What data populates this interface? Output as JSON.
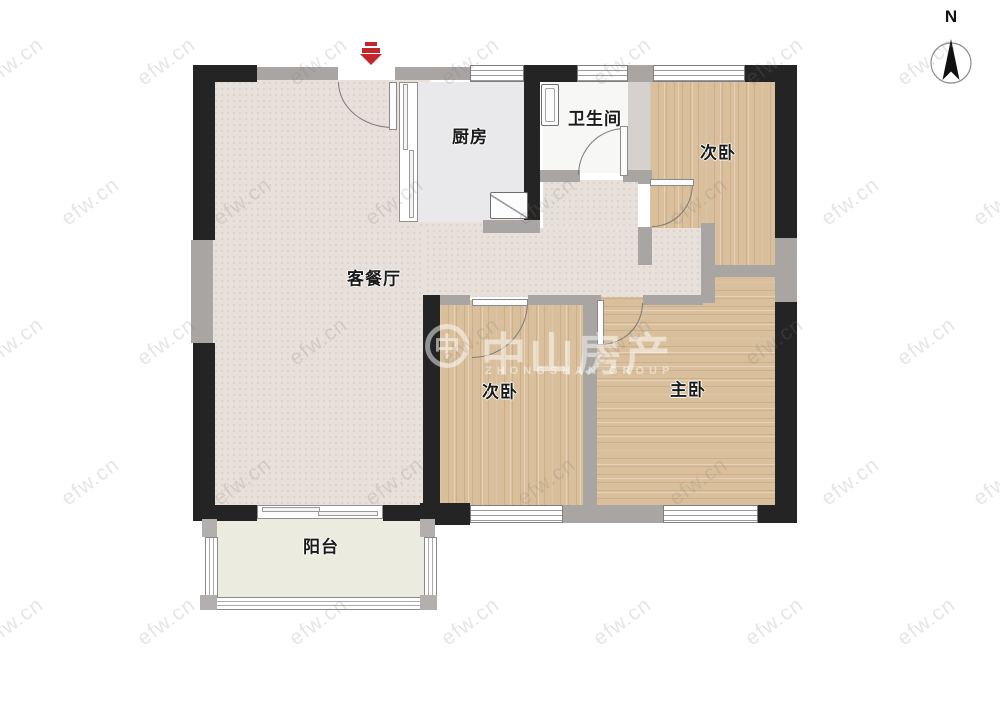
{
  "compass": {
    "label": "N"
  },
  "watermark": {
    "tile": "efw.cn",
    "brand_cn": "中山房产",
    "brand_mark": "中",
    "brand_en": "ZHONGSHAN GROUP"
  },
  "rooms": {
    "kitchen": {
      "label": "厨房"
    },
    "bathroom": {
      "label": "卫生间"
    },
    "bedroom_top_right": {
      "label": "次卧"
    },
    "living_dining": {
      "label": "客餐厅"
    },
    "bedroom_bottom_left": {
      "label": "次卧"
    },
    "master_bedroom": {
      "label": "主卧"
    },
    "balcony": {
      "label": "阳台"
    }
  },
  "colors": {
    "wall_black": "#242424",
    "wall_gray": "#a8a5a3",
    "wall_light": "#d4d1cf",
    "wood": "#d9bf9b",
    "living_floor": "#e8e0da",
    "kitchen_floor": "#e9e9eb",
    "bathroom_floor": "#f7f7f5",
    "balcony_floor": "#ebecdf",
    "entry_marker": "#c4272b",
    "door_stroke": "#7a7a7a"
  }
}
